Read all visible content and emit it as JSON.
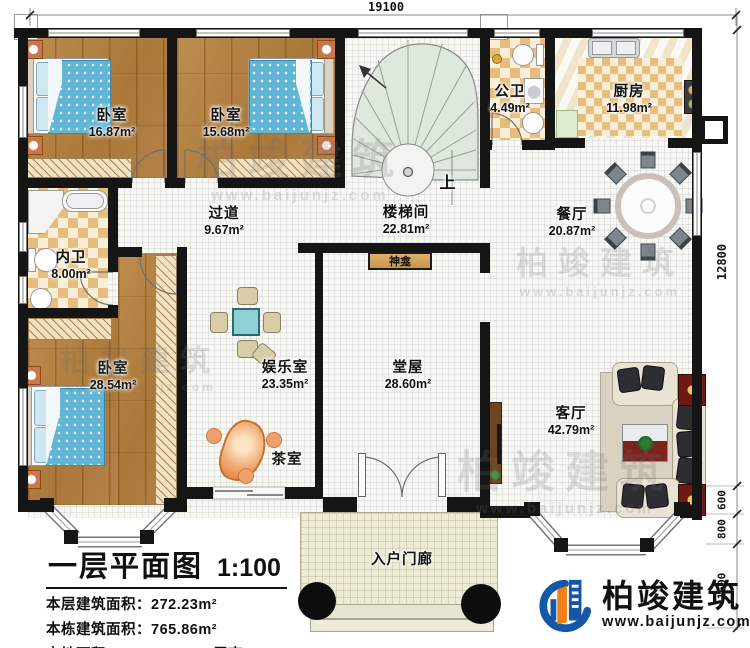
{
  "plan": {
    "rooms": [
      {
        "name": "卧室",
        "area": "16.87m²"
      },
      {
        "name": "卧室",
        "area": "15.68m²"
      },
      {
        "name": "内卫",
        "area": "8.00m²"
      },
      {
        "name": "过道",
        "area": "9.67m²"
      },
      {
        "name": "楼梯间",
        "area": "22.81m²"
      },
      {
        "name": "公卫",
        "area": "4.49m²"
      },
      {
        "name": "厨房",
        "area": "11.98m²"
      },
      {
        "name": "餐厅",
        "area": "20.87m²"
      },
      {
        "name": "卧室",
        "area": "28.54m²"
      },
      {
        "name": "娱乐室",
        "area": "23.35m²"
      },
      {
        "name": "茶室",
        "area": ""
      },
      {
        "name": "堂屋",
        "area": "28.60m²"
      },
      {
        "name": "客厅",
        "area": "42.79m²"
      },
      {
        "name": "入户门廊",
        "area": ""
      }
    ],
    "annotations": {
      "up": "上",
      "shrine": "神龛"
    }
  },
  "dimensions": {
    "top": "19100",
    "right": "12800",
    "seg_600": "600",
    "seg_800": "800",
    "seg_1600": "1600"
  },
  "title_block": {
    "title": "一层平面图",
    "scale": "1:100",
    "row1_label": "本层建筑面积：",
    "row1_value": "272.23m²",
    "row2_label": "本栋建筑面积：",
    "row2_value": "765.86m²",
    "row3_label": "占地面积：",
    "row3_value": "280.00m²",
    "row4_label": "层高：",
    "row4_value": "3.6m"
  },
  "logo": {
    "name": "柏竣建筑",
    "url": "www.baijunjz.com"
  },
  "watermark": {
    "text": "柏竣建筑",
    "url": "www.baijunjz.com"
  }
}
